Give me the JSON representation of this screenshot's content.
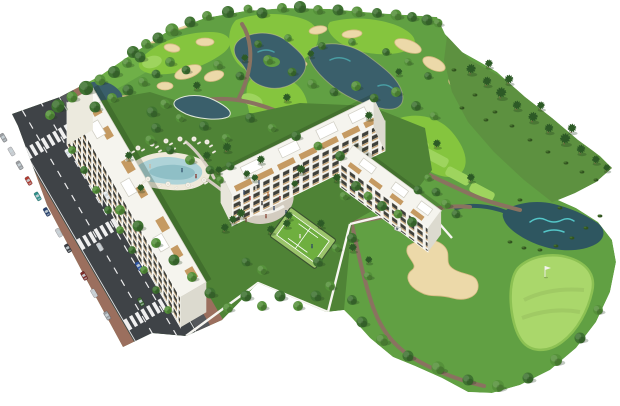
{
  "meta": {
    "title": "Aerial render of golf resort residential complex",
    "description": "Isometric architectural rendering: white apartment blocks along an avenue with parked cars, lagoon pool, plaza and padel court, surrounded by a golf course with lakes, sand bunkers, cart paths, putting green with flag and palm-lined slopes on white background"
  },
  "palette": {
    "bg": "#ffffff",
    "roughGreen": "#61a043",
    "slopeGreen": "#6fb048",
    "fairway": "#85c53e",
    "teeGreen": "#9ed45e",
    "puttingGreen": "#aad76b",
    "lawnGreen": "#4f8336",
    "scrubGreen": "#5d9140",
    "sand": "#ecd9a9",
    "sandEdge": "#d5ba82",
    "water": "#3a5f6b",
    "waterDeep": "#2e5660",
    "waterTeal": "#54c6c8",
    "pathBrown": "#8a7260",
    "plazaPaving": "#d3ccc0",
    "brick": "#9b6f5e",
    "asphalt": "#3f4347",
    "parking": "#55585c",
    "building": "#f5f4ee",
    "buildingShade": "#dcdacf",
    "facadeTan": "#c59a62",
    "windowDark": "#3f403a",
    "poolWater": "#aed3d8",
    "poolDeck": "#efe9da",
    "courtGreen": "#6faf3f",
    "courtApron": "#9bc46a",
    "fence": "#3a5230",
    "palm": "#2d5a26",
    "trunk": "#8a6b4a",
    "carGray": "#9a9da1",
    "carSilver": "#c8cbcf",
    "carRed": "#b03a30",
    "carTeal": "#2e8f8a",
    "carBlue": "#2f56a5",
    "carNavy": "#27406e",
    "carWhite": "#eef0f2",
    "carGreen": "#3e6b35",
    "carDark": "#3c3f44",
    "carMaroon": "#7e2d2a"
  },
  "scene": {
    "treeColors": [
      "#2f5a28",
      "#3f7331",
      "#55913a",
      "#6fae49"
    ],
    "trees": [
      [
        133,
        52,
        1.1,
        1
      ],
      [
        146,
        44,
        0.9,
        2
      ],
      [
        158,
        38,
        1.0,
        1
      ],
      [
        172,
        30,
        1.2,
        2
      ],
      [
        190,
        22,
        1.0,
        1
      ],
      [
        207,
        16,
        0.9,
        2
      ],
      [
        228,
        12,
        1.1,
        1
      ],
      [
        248,
        9,
        0.8,
        2
      ],
      [
        262,
        13,
        1.0,
        1
      ],
      [
        282,
        8,
        0.9,
        2
      ],
      [
        300,
        7,
        1.1,
        1
      ],
      [
        318,
        10,
        0.9,
        2
      ],
      [
        338,
        10,
        1.0,
        1
      ],
      [
        357,
        12,
        1.0,
        2
      ],
      [
        377,
        13,
        0.9,
        1
      ],
      [
        396,
        15,
        1.0,
        2
      ],
      [
        412,
        17,
        0.9,
        1
      ],
      [
        427,
        20,
        1.0,
        1
      ],
      [
        438,
        23,
        0.8,
        2
      ],
      [
        58,
        106,
        1.2,
        1
      ],
      [
        72,
        97,
        1.0,
        2
      ],
      [
        86,
        88,
        1.3,
        1
      ],
      [
        100,
        80,
        1.0,
        2
      ],
      [
        114,
        72,
        1.1,
        1
      ],
      [
        127,
        63,
        0.9,
        2
      ],
      [
        140,
        57,
        1.0,
        1
      ],
      [
        95,
        107,
        1.0,
        1
      ],
      [
        112,
        98,
        0.9,
        2
      ],
      [
        128,
        90,
        1.0,
        1
      ],
      [
        143,
        82,
        0.9,
        2
      ],
      [
        156,
        74,
        0.8,
        1
      ],
      [
        50,
        115,
        0.9,
        2
      ],
      [
        152,
        112,
        1.0,
        1
      ],
      [
        165,
        104,
        0.9,
        2
      ],
      [
        170,
        62,
        0.9,
        2
      ],
      [
        186,
        70,
        0.8,
        1
      ],
      [
        218,
        65,
        0.9,
        2
      ],
      [
        240,
        76,
        0.8,
        1
      ],
      [
        268,
        60,
        0.9,
        2
      ],
      [
        292,
        72,
        0.8,
        1
      ],
      [
        312,
        84,
        0.9,
        2
      ],
      [
        334,
        92,
        0.8,
        1
      ],
      [
        356,
        86,
        0.9,
        2
      ],
      [
        374,
        98,
        0.8,
        1
      ],
      [
        396,
        92,
        0.9,
        2
      ],
      [
        416,
        106,
        0.9,
        1
      ],
      [
        434,
        116,
        0.8,
        2
      ],
      [
        250,
        118,
        0.9,
        1
      ],
      [
        272,
        128,
        0.8,
        2
      ],
      [
        296,
        136,
        0.9,
        1
      ],
      [
        318,
        146,
        0.8,
        2
      ],
      [
        340,
        156,
        0.9,
        1
      ],
      [
        180,
        118,
        0.8,
        2
      ],
      [
        204,
        126,
        0.9,
        1
      ],
      [
        226,
        138,
        0.8,
        2
      ],
      [
        156,
        128,
        0.9,
        1
      ],
      [
        258,
        44,
        0.7,
        1
      ],
      [
        288,
        38,
        0.7,
        2
      ],
      [
        322,
        46,
        0.7,
        1
      ],
      [
        352,
        42,
        0.7,
        2
      ],
      [
        386,
        52,
        0.7,
        1
      ],
      [
        408,
        62,
        0.7,
        2
      ],
      [
        428,
        76,
        0.7,
        1
      ],
      [
        362,
        322,
        1.0,
        1
      ],
      [
        382,
        340,
        1.1,
        2
      ],
      [
        408,
        356,
        1.0,
        1
      ],
      [
        438,
        368,
        1.2,
        2
      ],
      [
        468,
        380,
        1.0,
        1
      ],
      [
        498,
        386,
        1.1,
        2
      ],
      [
        528,
        378,
        1.0,
        1
      ],
      [
        556,
        360,
        1.1,
        2
      ],
      [
        580,
        338,
        1.0,
        1
      ],
      [
        598,
        310,
        0.9,
        2
      ],
      [
        352,
        300,
        0.9,
        1
      ],
      [
        368,
        276,
        0.8,
        2
      ],
      [
        150,
        140,
        0.9,
        2
      ],
      [
        170,
        150,
        0.8,
        1
      ],
      [
        190,
        160,
        0.9,
        2
      ],
      [
        210,
        170,
        0.8,
        1
      ],
      [
        120,
        210,
        0.9,
        2
      ],
      [
        138,
        226,
        1.0,
        1
      ],
      [
        156,
        243,
        0.9,
        2
      ],
      [
        174,
        260,
        1.0,
        1
      ],
      [
        192,
        277,
        0.9,
        2
      ],
      [
        210,
        293,
        1.0,
        1
      ],
      [
        228,
        308,
        0.9,
        2
      ],
      [
        246,
        296,
        1.0,
        1
      ],
      [
        262,
        306,
        0.9,
        2
      ],
      [
        280,
        296,
        1.0,
        1
      ],
      [
        298,
        306,
        0.9,
        2
      ],
      [
        316,
        296,
        1.0,
        1
      ],
      [
        330,
        286,
        0.9,
        2
      ],
      [
        246,
        262,
        0.8,
        1
      ],
      [
        262,
        270,
        0.9,
        2
      ],
      [
        318,
        262,
        0.9,
        1
      ],
      [
        336,
        248,
        0.8,
        2
      ],
      [
        352,
        238,
        0.9,
        1
      ],
      [
        344,
        196,
        0.8,
        2
      ],
      [
        356,
        186,
        0.9,
        1
      ],
      [
        368,
        196,
        0.8,
        2
      ],
      [
        382,
        206,
        0.9,
        1
      ],
      [
        398,
        214,
        0.8,
        2
      ],
      [
        412,
        222,
        0.9,
        1
      ],
      [
        230,
        166,
        0.8,
        1
      ],
      [
        220,
        180,
        0.7,
        2
      ],
      [
        418,
        190,
        0.8,
        1
      ],
      [
        428,
        178,
        0.7,
        2
      ],
      [
        436,
        192,
        0.8,
        1
      ],
      [
        446,
        204,
        0.9,
        2
      ],
      [
        456,
        214,
        0.8,
        1
      ],
      [
        72,
        150,
        0.7,
        2
      ],
      [
        84,
        170,
        0.7,
        1
      ],
      [
        96,
        190,
        0.7,
        2
      ],
      [
        108,
        210,
        0.7,
        1
      ],
      [
        120,
        230,
        0.7,
        2
      ],
      [
        132,
        250,
        0.7,
        1
      ],
      [
        144,
        270,
        0.7,
        2
      ],
      [
        156,
        290,
        0.7,
        1
      ],
      [
        168,
        310,
        0.7,
        2
      ]
    ],
    "palms": [
      [
        470,
        72,
        1.1
      ],
      [
        486,
        84,
        1.0
      ],
      [
        500,
        96,
        1.2
      ],
      [
        516,
        108,
        1.0
      ],
      [
        532,
        120,
        1.1
      ],
      [
        548,
        131,
        1.0
      ],
      [
        564,
        142,
        1.2
      ],
      [
        580,
        152,
        1.0
      ],
      [
        595,
        162,
        0.9
      ],
      [
        606,
        170,
        0.8
      ],
      [
        488,
        66,
        0.9
      ],
      [
        508,
        82,
        1.0
      ],
      [
        540,
        108,
        0.9
      ],
      [
        571,
        131,
        1.0
      ],
      [
        196,
        88,
        0.9
      ],
      [
        286,
        100,
        0.9
      ],
      [
        368,
        118,
        0.9
      ],
      [
        436,
        146,
        0.9
      ],
      [
        470,
        180,
        0.9
      ],
      [
        244,
        60,
        0.8
      ],
      [
        310,
        56,
        0.8
      ],
      [
        398,
        74,
        0.8
      ],
      [
        226,
        150,
        1.0
      ],
      [
        260,
        162,
        0.9
      ],
      [
        300,
        172,
        1.0
      ],
      [
        336,
        180,
        0.9
      ],
      [
        240,
        216,
        1.0
      ],
      [
        270,
        232,
        0.9
      ],
      [
        224,
        230,
        0.9
      ],
      [
        254,
        180,
        0.8
      ],
      [
        288,
        218,
        0.9
      ],
      [
        320,
        226,
        0.9
      ],
      [
        352,
        250,
        0.9
      ],
      [
        368,
        262,
        0.8
      ],
      [
        128,
        158,
        0.9
      ],
      [
        206,
        158,
        0.9
      ],
      [
        218,
        172,
        0.8
      ],
      [
        140,
        190,
        0.8
      ],
      [
        232,
        222,
        0.9
      ],
      [
        286,
        226,
        0.9
      ],
      [
        246,
        176,
        0.8
      ],
      [
        294,
        186,
        0.8
      ]
    ],
    "shrubs": [
      [
        475,
        95,
        1
      ],
      [
        495,
        112,
        1
      ],
      [
        512,
        126,
        1
      ],
      [
        530,
        140,
        1
      ],
      [
        548,
        152,
        1
      ],
      [
        566,
        163,
        1
      ],
      [
        582,
        172,
        1
      ],
      [
        596,
        180,
        1
      ],
      [
        510,
        242,
        1
      ],
      [
        524,
        248,
        1
      ],
      [
        540,
        250,
        1
      ],
      [
        556,
        246,
        1
      ],
      [
        572,
        238,
        1
      ],
      [
        586,
        228,
        1
      ],
      [
        600,
        216,
        1
      ],
      [
        560,
        208,
        1
      ],
      [
        520,
        200,
        1
      ],
      [
        486,
        120,
        1
      ],
      [
        454,
        70,
        1
      ],
      [
        462,
        108,
        1
      ]
    ],
    "cars": [
      [
        3.4,
        137.7,
        59.8,
        "carGray"
      ],
      [
        11.5,
        151.5,
        59.8,
        "carSilver"
      ],
      [
        19.6,
        165.3,
        59.8,
        "carGray"
      ],
      [
        28.6,
        180.9,
        59.8,
        "carRed"
      ],
      [
        37.7,
        196.4,
        59.8,
        "carTeal"
      ],
      [
        46.8,
        211.9,
        59.8,
        "carNavy"
      ],
      [
        58.9,
        232.7,
        59.8,
        "carSilver"
      ],
      [
        67.9,
        248.3,
        59.8,
        "carDark"
      ],
      [
        84.1,
        275.9,
        59.8,
        "carMaroon"
      ],
      [
        94.1,
        293.2,
        59.8,
        "carSilver"
      ],
      [
        107.2,
        315.6,
        59.8,
        "carGray"
      ],
      [
        68.1,
        153.2,
        59.8,
        "carWhite"
      ],
      [
        106.7,
        195.5,
        59.8,
        "carWhite"
      ],
      [
        138.6,
        266.1,
        59.8,
        "carBlue"
      ],
      [
        140.9,
        301.8,
        59.8,
        "carGreen"
      ],
      [
        99.7,
        247.0,
        59.8,
        "carSilver"
      ]
    ],
    "people": [
      [
        244,
        194,
        "#3b4b66"
      ],
      [
        250,
        200,
        "#a33d33"
      ],
      [
        256,
        190,
        "#e8e4da"
      ],
      [
        262,
        205,
        "#2f2f2f"
      ],
      [
        268,
        196,
        "#b6713f"
      ],
      [
        274,
        210,
        "#3b4b66"
      ],
      [
        280,
        200,
        "#7e2d2a"
      ],
      [
        286,
        214,
        "#2f4858"
      ],
      [
        252,
        212,
        "#c7c2b4"
      ],
      [
        240,
        206,
        "#44443f"
      ],
      [
        266,
        218,
        "#8a4a3a"
      ],
      [
        288,
        190,
        "#35526b"
      ],
      [
        259,
        184,
        "#52607a"
      ],
      [
        246,
        222,
        "#6b4a3a"
      ],
      [
        150,
        168,
        "#c9b9a5"
      ],
      [
        182,
        172,
        "#3a5a74"
      ],
      [
        196,
        178,
        "#8a3a30"
      ],
      [
        300,
        238,
        "#e8e4da"
      ],
      [
        312,
        248,
        "#304a63"
      ]
    ],
    "umbrellas": [
      [
        138,
        148
      ],
      [
        152,
        144
      ],
      [
        166,
        141
      ],
      [
        180,
        139
      ],
      [
        194,
        139
      ],
      [
        207,
        142
      ],
      [
        148,
        179
      ],
      [
        168,
        184
      ],
      [
        188,
        185
      ],
      [
        204,
        180
      ]
    ],
    "loungers": [
      [
        133,
        152,
        -30
      ],
      [
        143,
        150,
        -30
      ],
      [
        157,
        147,
        -30
      ],
      [
        171,
        144,
        -30
      ],
      [
        185,
        143,
        -30
      ],
      [
        199,
        143,
        -30
      ],
      [
        211,
        146,
        -30
      ],
      [
        144,
        182,
        -30
      ],
      [
        160,
        186,
        -30
      ],
      [
        176,
        188,
        -30
      ],
      [
        192,
        187,
        -30
      ],
      [
        206,
        183,
        -30
      ],
      [
        127,
        160,
        -30
      ],
      [
        214,
        152,
        -30
      ],
      [
        160,
        151,
        -30
      ],
      [
        174,
        149,
        -30
      ]
    ],
    "flag": {
      "x": 545,
      "y": 277
    },
    "golf_cart": {
      "x": 398,
      "y": 229,
      "angle": 20
    }
  }
}
